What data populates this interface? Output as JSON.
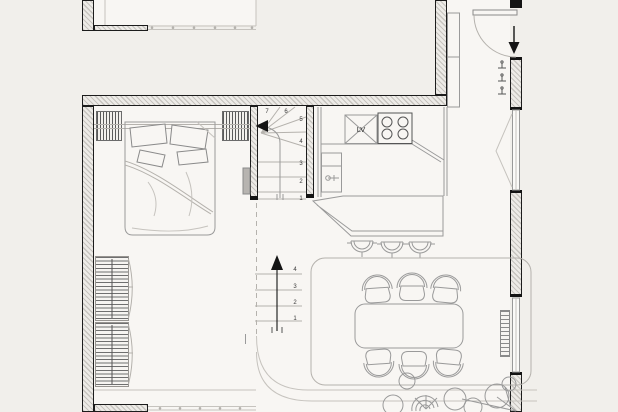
{
  "plan": {
    "labels": {
      "dishwasher": "LV"
    },
    "stairs": {
      "upper_flight": {
        "steps": [
          "7",
          "6",
          "5",
          "4",
          "3",
          "2",
          "1"
        ]
      },
      "lower_flight": {
        "steps": [
          "4",
          "3",
          "2",
          "1"
        ]
      }
    },
    "colors": {
      "background": "#f1efeb",
      "floor": "#f8f6f3",
      "wall_line": "#1c1c1c",
      "wall_hatch": "#c7c4bf",
      "drawing_line": "#9a9a9a",
      "accent_black": "#141414"
    }
  }
}
